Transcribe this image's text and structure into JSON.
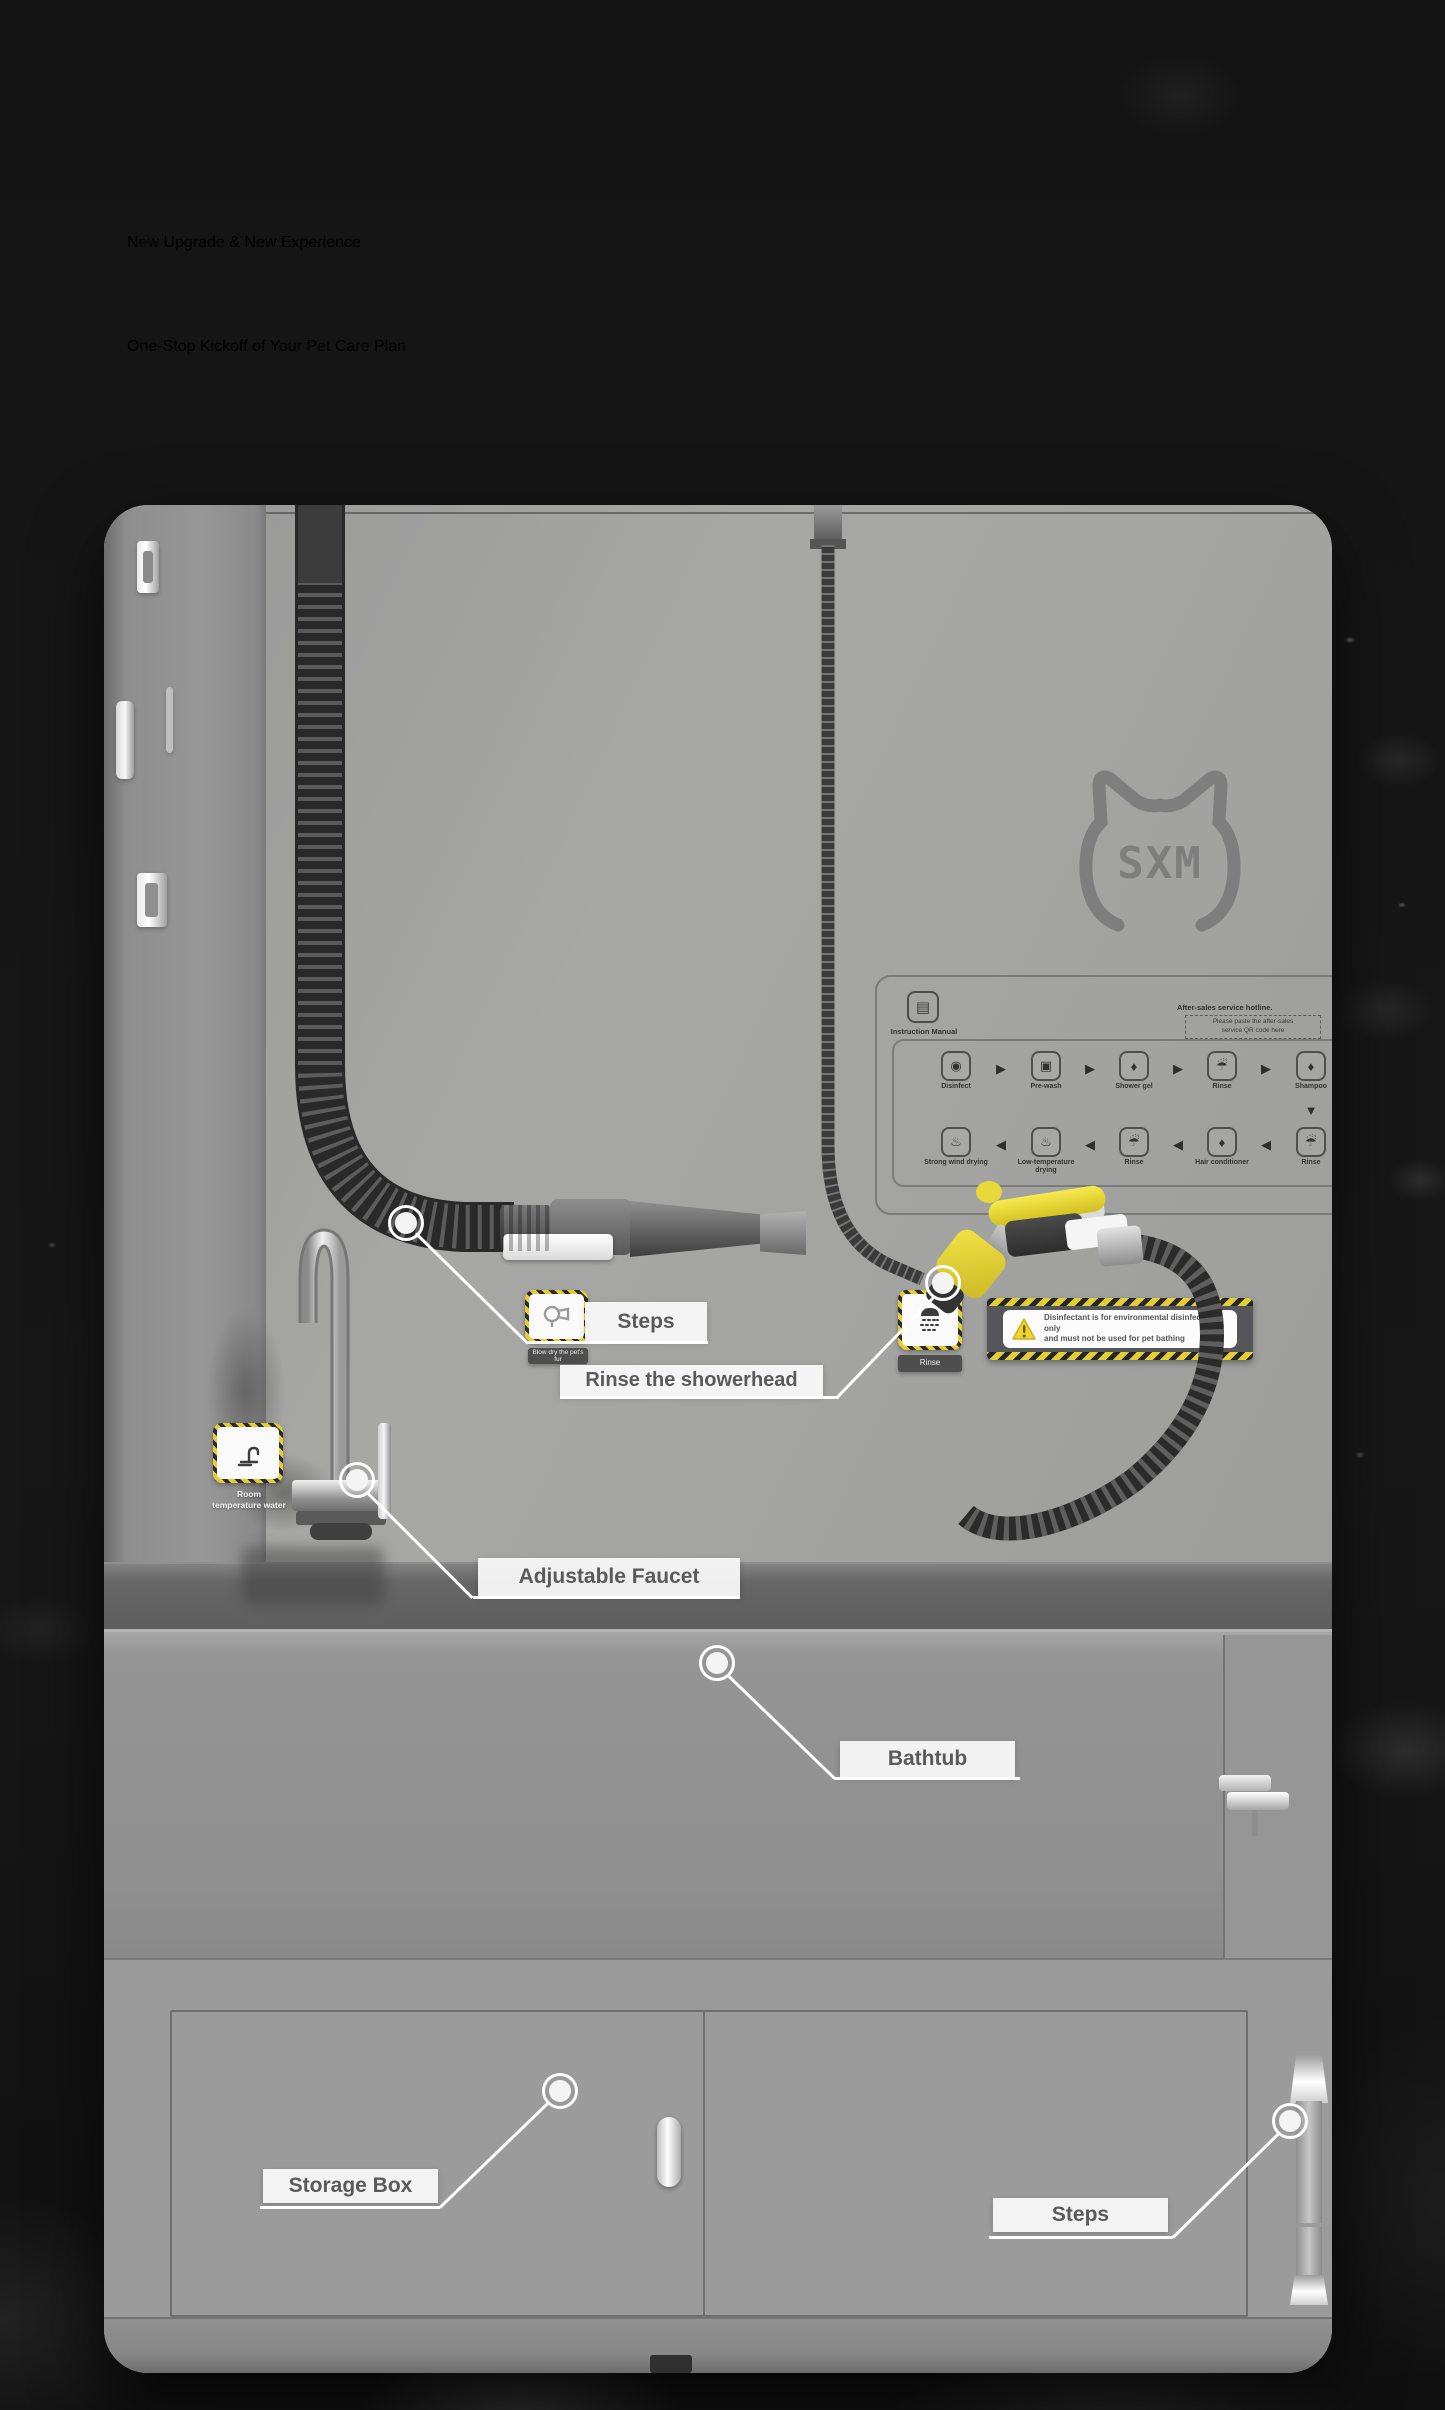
{
  "heading": {
    "line1": "New Upgrade & New Experience",
    "line2": "One-Stop Kickoff of Your Pet Care Plan"
  },
  "logo": {
    "text": "SXM"
  },
  "callouts": {
    "steps_top": {
      "label": "Steps"
    },
    "rinse_showerhead": {
      "label": "Rinse the showerhead"
    },
    "adjustable_faucet": {
      "label": "Adjustable Faucet"
    },
    "bathtub": {
      "label": "Bathtub"
    },
    "storage_box": {
      "label": "Storage Box"
    },
    "steps_bottom": {
      "label": "Steps"
    }
  },
  "stickers": {
    "faucet": {
      "caption_line1": "Room",
      "caption_line2": "temperature water"
    },
    "dryer": {
      "caption": "Blow dry the pet's fur"
    },
    "shower": {
      "caption": "Rinse"
    }
  },
  "warning_label": {
    "line1": "Disinfectant is for environmental disinfection only",
    "line2": "and must not be used for pet bathing"
  },
  "instruction_panel": {
    "manual_icon_glyph": "▤",
    "manual_label": "Instruction Manual",
    "hotline": "After-sales service hotline.",
    "paste_note_line1": "Please paste the after-sales",
    "paste_note_line2": "service QR code here",
    "arrow_right": "▶",
    "arrow_left": "◀",
    "arrow_down": "▼",
    "flow_row1": [
      {
        "glyph": "◉",
        "label": "Disinfect"
      },
      {
        "glyph": "▣",
        "label": "Pre-wash"
      },
      {
        "glyph": "♦",
        "label": "Shower gel"
      },
      {
        "glyph": "☔",
        "label": "Rinse"
      },
      {
        "glyph": "♦",
        "label": "Shampoo"
      }
    ],
    "flow_row2": [
      {
        "glyph": "♨",
        "label": "Strong wind drying"
      },
      {
        "glyph": "♨",
        "label": "Low-temperature drying"
      },
      {
        "glyph": "☔",
        "label": "Rinse"
      },
      {
        "glyph": "♦",
        "label": "Hair conditioner"
      },
      {
        "glyph": "☔",
        "label": "Rinse"
      }
    ]
  },
  "colors": {
    "accent_yellow": "#e3cf35",
    "panel_gray": "#a1a1a1",
    "background": "#161616",
    "label_text": "#5a5a5a"
  }
}
